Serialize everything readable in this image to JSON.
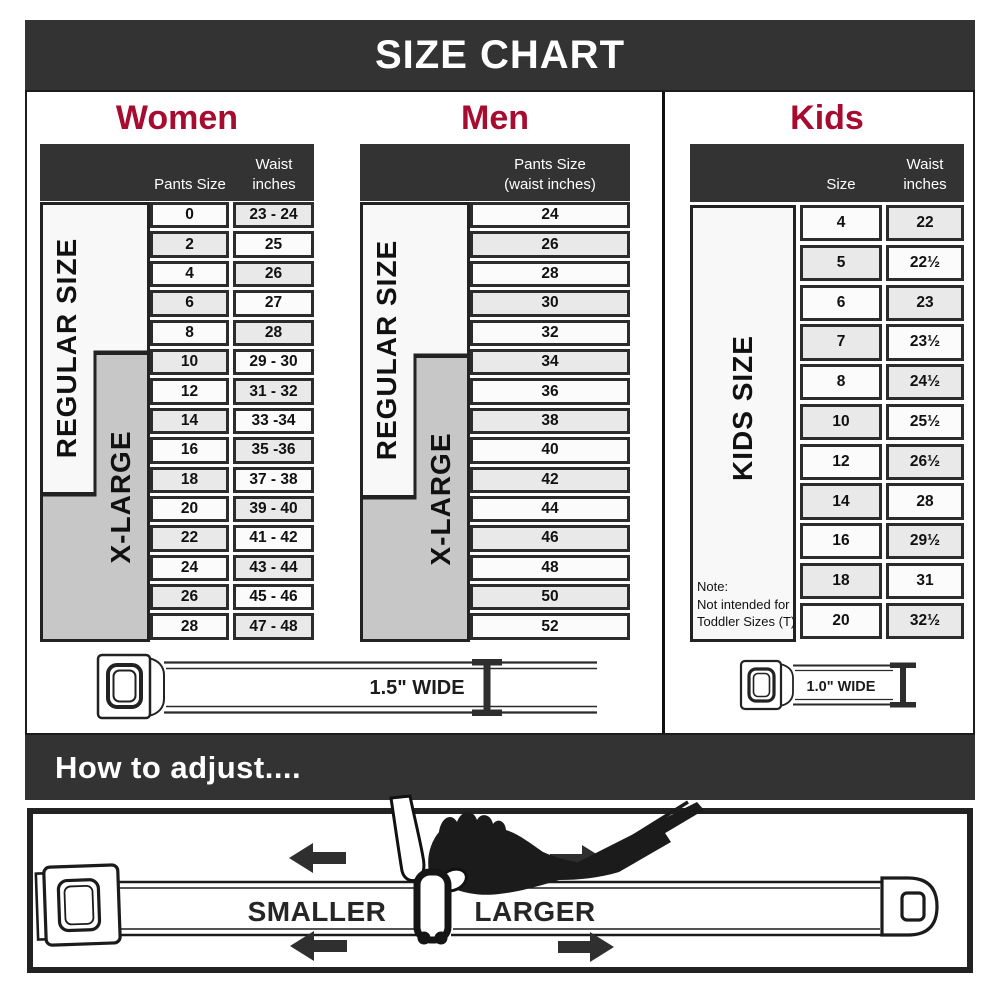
{
  "title": "SIZE CHART",
  "women": {
    "heading": "Women",
    "regular_label": "REGULAR SIZE",
    "xlarge_label": "X-LARGE",
    "col1_header": "Pants Size",
    "col2_header_line1": "Waist",
    "col2_header_line2": "inches",
    "rows": [
      {
        "pants_size": "0",
        "waist": "23 - 24"
      },
      {
        "pants_size": "2",
        "waist": "25"
      },
      {
        "pants_size": "4",
        "waist": "26"
      },
      {
        "pants_size": "6",
        "waist": "27"
      },
      {
        "pants_size": "8",
        "waist": "28"
      },
      {
        "pants_size": "10",
        "waist": "29 - 30"
      },
      {
        "pants_size": "12",
        "waist": "31 - 32"
      },
      {
        "pants_size": "14",
        "waist": "33 -34"
      },
      {
        "pants_size": "16",
        "waist": "35 -36"
      },
      {
        "pants_size": "18",
        "waist": "37 - 38"
      },
      {
        "pants_size": "20",
        "waist": "39 - 40"
      },
      {
        "pants_size": "22",
        "waist": "41 - 42"
      },
      {
        "pants_size": "24",
        "waist": "43 - 44"
      },
      {
        "pants_size": "26",
        "waist": "45 - 46"
      },
      {
        "pants_size": "28",
        "waist": "47 - 48"
      }
    ]
  },
  "men": {
    "heading": "Men",
    "regular_label": "REGULAR SIZE",
    "xlarge_label": "X-LARGE",
    "col_header_line1": "Pants Size",
    "col_header_line2": "(waist inches)",
    "rows": [
      "24",
      "26",
      "28",
      "30",
      "32",
      "34",
      "36",
      "38",
      "40",
      "42",
      "44",
      "46",
      "48",
      "50",
      "52"
    ]
  },
  "kids": {
    "heading": "Kids",
    "size_label": "KIDS SIZE",
    "col1_header": "Size",
    "col2_header_line1": "Waist",
    "col2_header_line2": "inches",
    "note_line1": "Note:",
    "note_line2": "Not intended for",
    "note_line3": "Toddler Sizes (T)",
    "rows": [
      {
        "size": "4",
        "waist": "22"
      },
      {
        "size": "5",
        "waist": "22½"
      },
      {
        "size": "6",
        "waist": "23"
      },
      {
        "size": "7",
        "waist": "23½"
      },
      {
        "size": "8",
        "waist": "24½"
      },
      {
        "size": "10",
        "waist": "25½"
      },
      {
        "size": "12",
        "waist": "26½"
      },
      {
        "size": "14",
        "waist": "28"
      },
      {
        "size": "16",
        "waist": "29½"
      },
      {
        "size": "18",
        "waist": "31"
      },
      {
        "size": "20",
        "waist": "32½"
      }
    ]
  },
  "belts": {
    "adult_width_label": "1.5\" WIDE",
    "kids_width_label": "1.0\" WIDE"
  },
  "how_to_adjust": {
    "heading": "How to adjust....",
    "smaller_label": "SMALLER",
    "larger_label": "LARGER"
  },
  "colors": {
    "accent_red": "#a60c2f",
    "header_dark": "#333333",
    "xlarge_gray": "#c7c7c7",
    "row_shaded": "#e9e9e9"
  }
}
